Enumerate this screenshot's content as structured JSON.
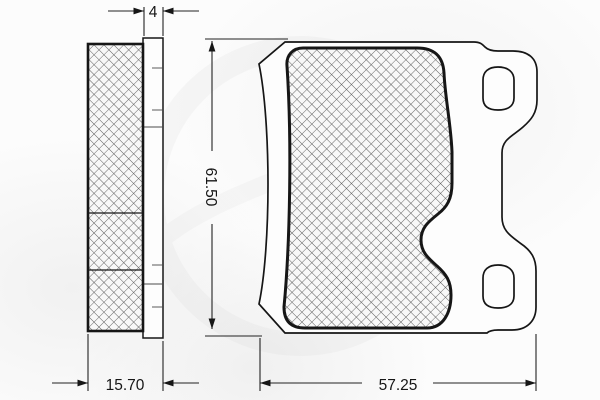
{
  "dimensions": {
    "backplate_thickness": "4",
    "overall_thickness": "15.70",
    "pad_height": "61.50",
    "pad_width": "57.25"
  },
  "colors": {
    "line": "#161616",
    "hatch": "#5a5a5a",
    "paper": "#fcfcfc"
  }
}
